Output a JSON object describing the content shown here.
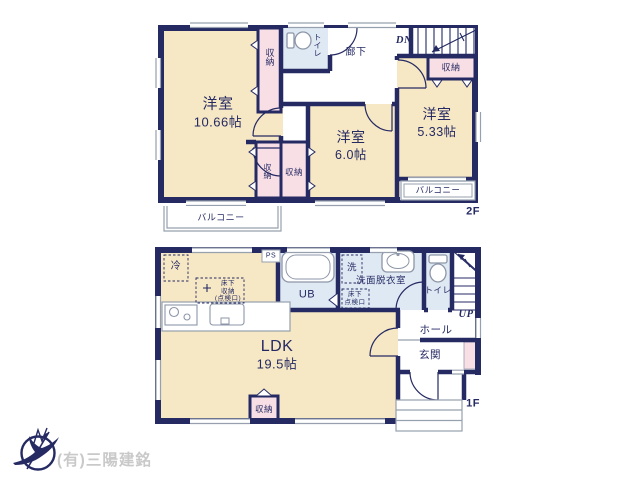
{
  "floor2": {
    "label": "2F",
    "room1": {
      "name": "洋室",
      "size": "10.66帖"
    },
    "room2": {
      "name": "洋室",
      "size": "6.0帖"
    },
    "room3": {
      "name": "洋室",
      "size": "5.33帖"
    },
    "closet_top": "収納",
    "closet_mid_left": "収納",
    "closet_mid_right": "収納",
    "closet_stairs": "収納",
    "toilet": "トイレ",
    "hallway": "廊下",
    "stairs": "DN",
    "balcony_left": "バルコニー",
    "balcony_right": "バルコニー"
  },
  "floor1": {
    "label": "1F",
    "ldk": {
      "name": "LDK",
      "size": "19.5帖"
    },
    "fridge": "冷",
    "ps": "PS",
    "underfloor_storage": [
      "床下",
      "収納",
      "(点検口)"
    ],
    "washer": "洗",
    "washroom": "洗面脱衣室",
    "underfloor_hatch": [
      "床下",
      "点検口"
    ],
    "bath": "UB",
    "toilet": "トイレ",
    "stairs": "UP",
    "hall": "ホール",
    "entrance": "玄関",
    "closet": "収納"
  },
  "logo": {
    "company": "(有)三陽建銘"
  },
  "colors": {
    "wall": "#252a63",
    "room": "#f6e7c5",
    "closet": "#f8dfe6",
    "wet": "#dfe9f3",
    "line": "#97a0ae",
    "logo_text": "#c9c9c9"
  }
}
